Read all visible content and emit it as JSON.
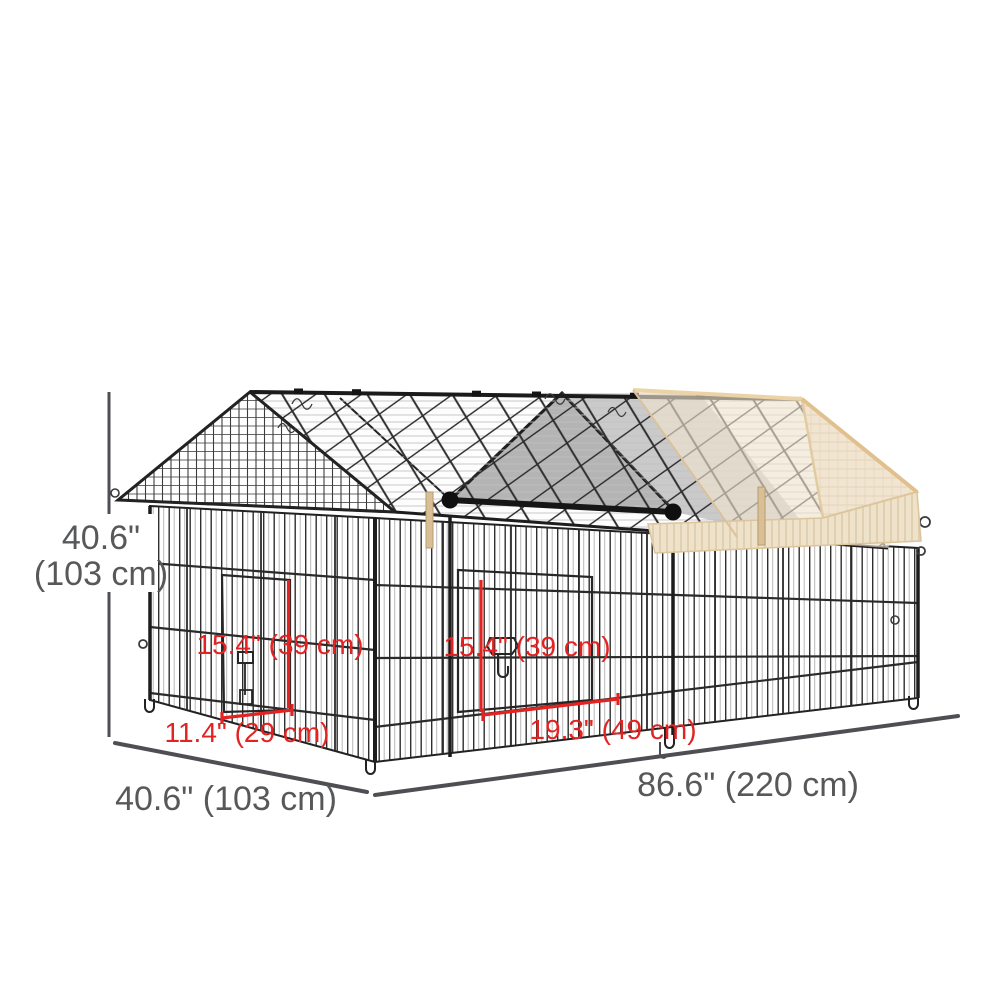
{
  "diagram": {
    "type": "product-dimension-diagram",
    "subject": "Outdoor metal pet playpen enclosure with peaked wire mesh roof, two doors and beige canopy cover on right half",
    "brand_label": "PawHut",
    "overall_dimensions": {
      "height_in": "40.6\"",
      "height_cm": "(103 cm)",
      "depth_label": "40.6\" (103 cm)",
      "length_label": "86.6\" (220 cm)"
    },
    "door_dimensions": {
      "side_door_height_label": "15.4\" (39 cm)",
      "side_door_width_label": "11.4\" (29 cm)",
      "front_door_height_label": "15.4\" (39 cm)",
      "front_door_width_label": "19.3\" (49 cm)"
    },
    "colors": {
      "dimension_text": "#57585a",
      "dimension_line": "#4e4f52",
      "annotation_red": "#e32222",
      "wire_dark": "#2e2e2e",
      "wire_light": "#b7b7b7",
      "cover_beige": "#f1e5d1",
      "cover_trim": "#e0c08c",
      "background": "#ffffff"
    }
  }
}
